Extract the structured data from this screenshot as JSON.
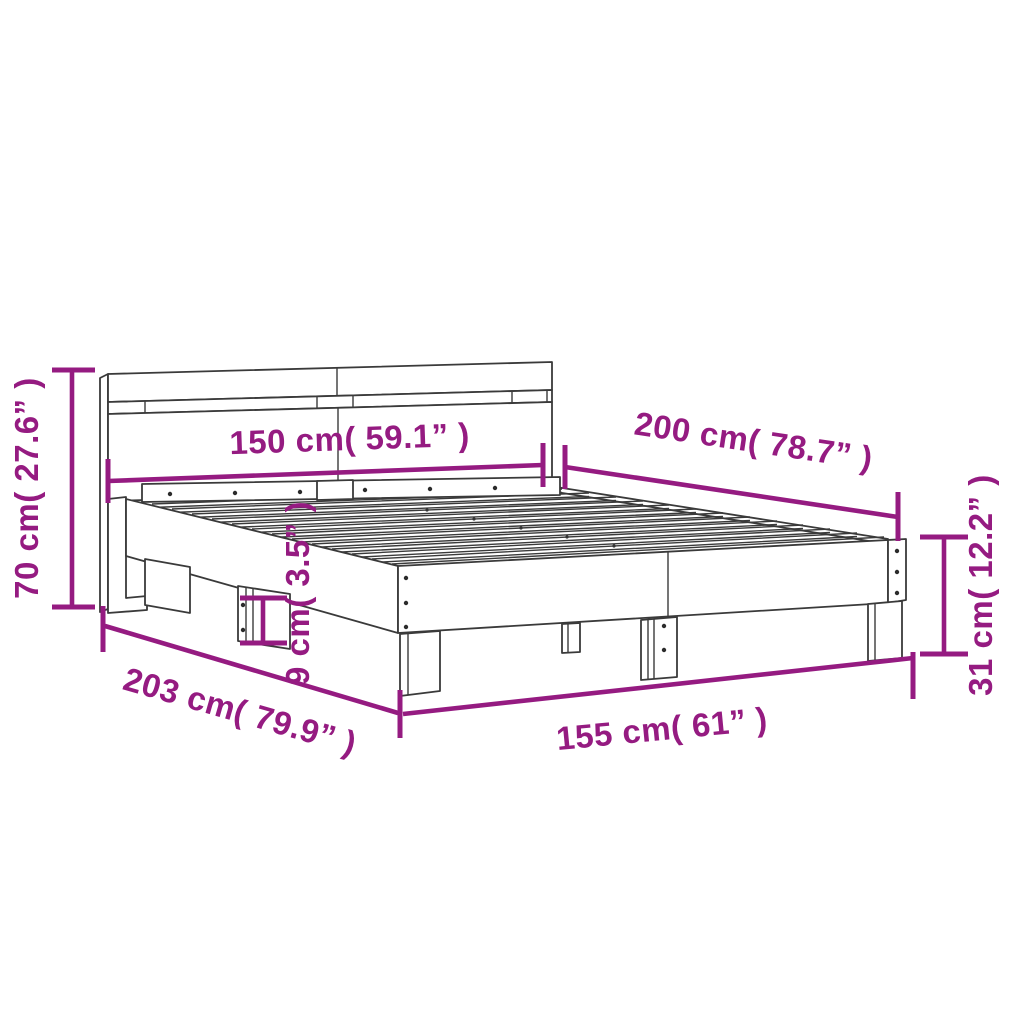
{
  "diagram": {
    "title": "bed-frame-with-headboard-dimension-diagram",
    "background_color": "#FFFFFF",
    "drawing_line_color": "#3A3A3A",
    "accent_color": "#951B81",
    "dimensions": {
      "headboard_height": {
        "value_cm": 70,
        "value_in": 27.6,
        "label": "70 cm( 27.6” )"
      },
      "bed_width": {
        "value_cm": 150,
        "value_in": 59.1,
        "label": "150 cm( 59.1” )"
      },
      "bed_length": {
        "value_cm": 200,
        "value_in": 78.7,
        "label": "200 cm( 78.7” )"
      },
      "frame_height": {
        "value_cm": 31,
        "value_in": 12.2,
        "label": "31 cm( 12.2” )"
      },
      "rail_thickness": {
        "value_cm": 9,
        "value_in": 3.5,
        "label": "9 cm( 3.5” )"
      },
      "total_length": {
        "value_cm": 203,
        "value_in": 79.9,
        "label": "203 cm( 79.9” )"
      },
      "total_width": {
        "value_cm": 155,
        "value_in": 61,
        "label": "155 cm( 61” )"
      }
    }
  }
}
